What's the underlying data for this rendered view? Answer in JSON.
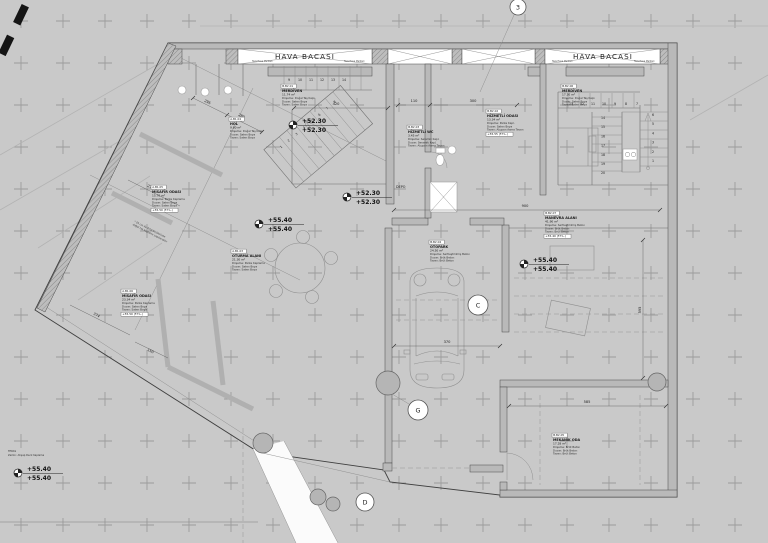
{
  "labels": {
    "hava_bacasi_1": "HAVA BACASI",
    "hava_bacasi_2": "HAVA BACASI",
    "depo": "DEPO",
    "vent_note": "Taze Hava Menfezi",
    "teras_line1": "TERAS",
    "teras_line2": "Zemin: Ahşap Deck Kaplama",
    "site_note_1": "* 25 cm ile 3/10 ölçülerinde",
    "site_note_2": "doğal taş kaplama yapılacaktır"
  },
  "axes": {
    "n3": "3",
    "c": "C",
    "g": "G",
    "d": "D"
  },
  "elevations": {
    "stair_upper": {
      "top": "+52.30",
      "bottom": "+52.30"
    },
    "stair_lower": {
      "top": "+52.30",
      "bottom": "+52.30"
    },
    "oturma": {
      "top": "+55.40",
      "bottom": "+55.40"
    },
    "avlu": {
      "top": "+55.40",
      "bottom": "+55.40"
    },
    "teras": {
      "top": "+55.40",
      "bottom": "+55.40"
    }
  },
  "rooms": {
    "merdiven_a": {
      "code": "B.B2.01",
      "name": "MERDİVEN",
      "area": "11.74 m²",
      "lines": [
        "Döşeme: Doğal Taş Kapl.",
        "Duvar: Saten Boya",
        "Tavan: Saten Boya"
      ]
    },
    "merdiven_b": {
      "code": "B.B2.06",
      "name": "MERDİVEN",
      "area": "17.30 m²",
      "lines": [
        "Döşeme: Doğal Taş Kapl.",
        "Duvar: Saten Boya",
        "Tavan: Saten Boya"
      ]
    },
    "hol": {
      "code": "A.B1.04",
      "name": "HOL",
      "area": "9.80 m²",
      "lines": [
        "Döşeme: Doğal Taş Kapl.",
        "Duvar: Saten Boya",
        "Tavan: Saten Boya"
      ]
    },
    "hizmetli_wc": {
      "code": "B.B2.03",
      "name": "HİZMETLİ WC",
      "area": "3.45 m²",
      "lines": [
        "Döşeme: Seramik Kapl.",
        "Duvar: Seramik Kapl.",
        "Tavan: Alçıpan Asma Tavan"
      ]
    },
    "hizmetli_odasi": {
      "code": "B.B2.02",
      "name": "HİZMETLİ ODASI",
      "area": "13.34 m²",
      "lines": [
        "Döşeme: Parke Kapl.",
        "Duvar: Saten Boya",
        "Tavan: Alçıpan Asma Tavan"
      ],
      "kot": "+55.55 (F.T.L.)"
    },
    "otopark": {
      "code": "B.B2.04",
      "name": "OTOPARK",
      "area": "24.50 m²",
      "lines": [
        "Döşeme: Sertleştirilmiş Beton",
        "Duvar: Brüt Beton",
        "Tavan: Brüt Beton"
      ]
    },
    "manevra": {
      "code": "B.B2.07",
      "name": "MANEVRA ALANI",
      "area": "41.90 m²",
      "lines": [
        "Döşeme: Sertleştirilmiş Beton",
        "Duvar: Brüt Beton",
        "Tavan: Brüt Beton"
      ],
      "kot": "+55.40 (F.T.L.)"
    },
    "mekanik": {
      "code": "B.B2.05",
      "name": "MEKANİK ODA",
      "area": "17.28 m²",
      "lines": [
        "Döşeme: Brüt Beton",
        "Duvar: Brüt Beton",
        "Tavan: Brüt Beton"
      ]
    },
    "misafir_1": {
      "code": "A.B1.05",
      "name": "MİSAFİR ODASI",
      "area": "15.70 m²",
      "lines": [
        "Döşeme: Parke Kaplama",
        "Duvar: Saten Boya",
        "Tavan: Saten Boya"
      ],
      "kot": "+55.50 (F.T.L.)"
    },
    "misafir_2": {
      "code": "A.B1.06",
      "name": "MİSAFİR ODASI",
      "area": "23.34 m²",
      "lines": [
        "Döşeme: Parke Kaplama",
        "Duvar: Saten Boya",
        "Tavan: Saten Boya"
      ],
      "kot": "+55.50 (F.T.L.)"
    },
    "oturma": {
      "code": "A.B1.03",
      "name": "OTURMA ALANI",
      "area": "21.30 m²",
      "lines": [
        "Döşeme: Parke Kaplama",
        "Duvar: Saten Boya",
        "Tavan: Saten Boya"
      ]
    }
  },
  "stairs": {
    "right_top": [
      "13",
      "12",
      "11",
      "10",
      "9",
      "8",
      "7"
    ],
    "right_left": [
      "14",
      "15",
      "16",
      "17",
      "18",
      "19",
      "20"
    ],
    "right_right": [
      "6",
      "5",
      "4",
      "3",
      "2",
      "1"
    ],
    "diag": [
      "1",
      "2",
      "3",
      "4",
      "5",
      "6",
      "7",
      "8"
    ],
    "diag_top": [
      "9",
      "10",
      "11",
      "12",
      "13",
      "14"
    ]
  },
  "dims": {
    "d420": "420",
    "d295": "295",
    "d280": "280",
    "d270": "270",
    "d374": "374",
    "d150": "150",
    "d110": "110",
    "d300": "300",
    "d900": "900",
    "d370": "370",
    "d585": "585",
    "d595": "595"
  }
}
